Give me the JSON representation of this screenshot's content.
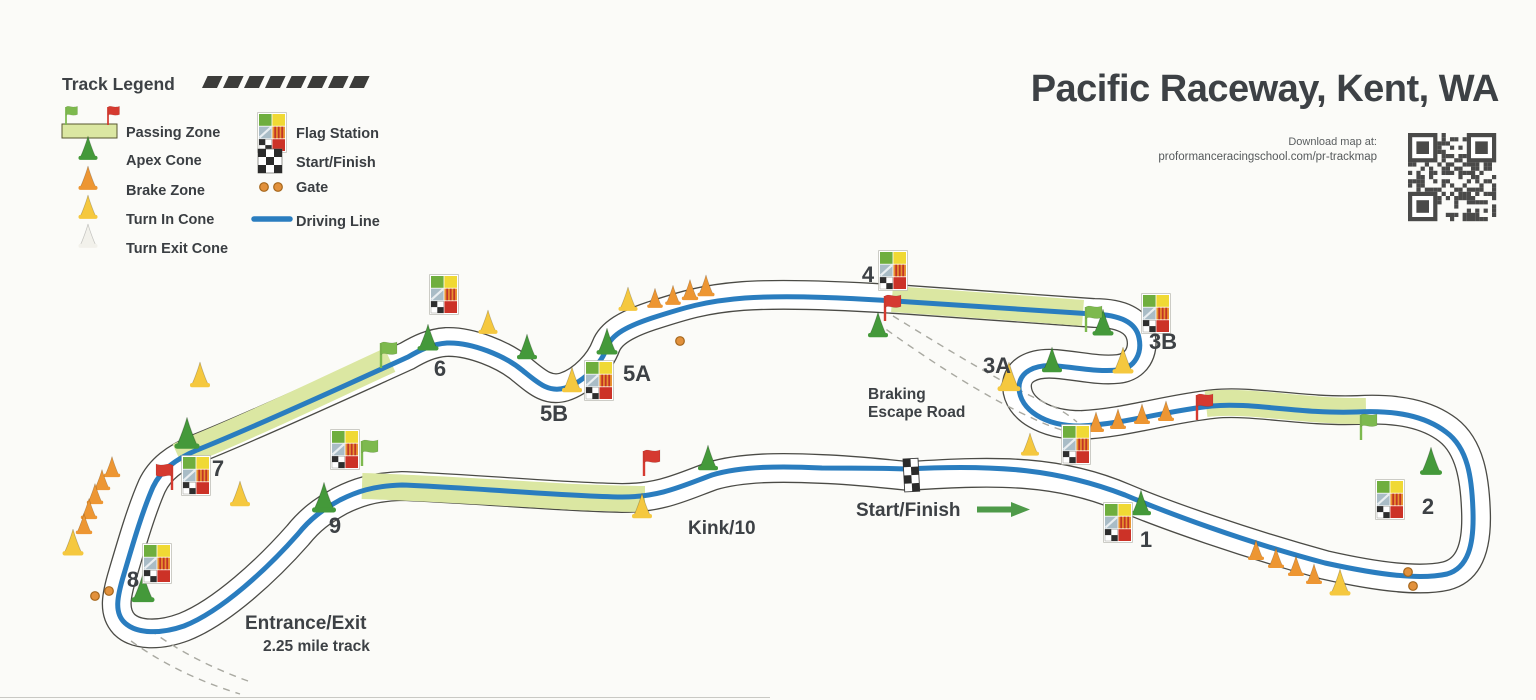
{
  "header": {
    "title": "Pacific Raceway, Kent, WA",
    "download_note": "Download map at:",
    "download_url": "proformanceracingschool.com/pr-trackmap"
  },
  "legend": {
    "title": "Track Legend",
    "left_items": [
      "Passing Zone",
      "Apex Cone",
      "Brake Zone",
      "Turn In Cone",
      "Turn Exit Cone"
    ],
    "right_items": [
      "Flag Station",
      "Start/Finish",
      "Gate",
      "Driving Line"
    ]
  },
  "labels": {
    "start_finish": "Start/Finish",
    "kink": "Kink/10",
    "braking_line1": "Braking",
    "braking_line2": "Escape Road",
    "entrance": "Entrance/Exit",
    "track_length": "2.25 mile track"
  },
  "turns": [
    {
      "id": "1",
      "x": 1146,
      "y": 547
    },
    {
      "id": "2",
      "x": 1428,
      "y": 514
    },
    {
      "id": "3A",
      "x": 997,
      "y": 373
    },
    {
      "id": "3B",
      "x": 1163,
      "y": 349
    },
    {
      "id": "4",
      "x": 868,
      "y": 282
    },
    {
      "id": "5A",
      "x": 637,
      "y": 381
    },
    {
      "id": "5B",
      "x": 554,
      "y": 421
    },
    {
      "id": "6",
      "x": 440,
      "y": 376
    },
    {
      "id": "7",
      "x": 218,
      "y": 476
    },
    {
      "id": "8",
      "x": 133,
      "y": 587
    },
    {
      "id": "9",
      "x": 335,
      "y": 533
    }
  ],
  "markers": {
    "cones": [
      {
        "t": "apex",
        "x": 187,
        "y": 441,
        "s": 1.25
      },
      {
        "t": "apex",
        "x": 143,
        "y": 595,
        "s": 1.15
      },
      {
        "t": "apex",
        "x": 324,
        "y": 505,
        "s": 1.2
      },
      {
        "t": "apex",
        "x": 708,
        "y": 464,
        "s": 1.0
      },
      {
        "t": "apex",
        "x": 1141,
        "y": 509,
        "s": 1.0
      },
      {
        "t": "apex",
        "x": 1431,
        "y": 468,
        "s": 1.1
      },
      {
        "t": "apex",
        "x": 1052,
        "y": 366,
        "s": 1.0
      },
      {
        "t": "apex",
        "x": 1103,
        "y": 329,
        "s": 1.05
      },
      {
        "t": "apex",
        "x": 878,
        "y": 331,
        "s": 1.0
      },
      {
        "t": "apex",
        "x": 607,
        "y": 348,
        "s": 1.05
      },
      {
        "t": "apex",
        "x": 527,
        "y": 353,
        "s": 1.0
      },
      {
        "t": "apex",
        "x": 428,
        "y": 344,
        "s": 1.05
      },
      {
        "t": "brake",
        "x": 112,
        "y": 472,
        "s": 0.82
      },
      {
        "t": "brake",
        "x": 102,
        "y": 485,
        "s": 0.82
      },
      {
        "t": "brake",
        "x": 95,
        "y": 499,
        "s": 0.82
      },
      {
        "t": "brake",
        "x": 89,
        "y": 514,
        "s": 0.82
      },
      {
        "t": "brake",
        "x": 84,
        "y": 529,
        "s": 0.82
      },
      {
        "t": "brake",
        "x": 655,
        "y": 303,
        "s": 0.78
      },
      {
        "t": "brake",
        "x": 673,
        "y": 300,
        "s": 0.78
      },
      {
        "t": "brake",
        "x": 690,
        "y": 295,
        "s": 0.82
      },
      {
        "t": "brake",
        "x": 706,
        "y": 291,
        "s": 0.85
      },
      {
        "t": "brake",
        "x": 1096,
        "y": 427,
        "s": 0.8
      },
      {
        "t": "brake",
        "x": 1118,
        "y": 424,
        "s": 0.8
      },
      {
        "t": "brake",
        "x": 1142,
        "y": 419,
        "s": 0.8
      },
      {
        "t": "brake",
        "x": 1166,
        "y": 416,
        "s": 0.8
      },
      {
        "t": "brake",
        "x": 1256,
        "y": 555,
        "s": 0.8
      },
      {
        "t": "brake",
        "x": 1276,
        "y": 563,
        "s": 0.8
      },
      {
        "t": "brake",
        "x": 1296,
        "y": 571,
        "s": 0.8
      },
      {
        "t": "brake",
        "x": 1314,
        "y": 579,
        "s": 0.8
      },
      {
        "t": "turnin",
        "x": 73,
        "y": 549,
        "s": 1.05
      },
      {
        "t": "turnin",
        "x": 200,
        "y": 381,
        "s": 1.0
      },
      {
        "t": "turnin",
        "x": 240,
        "y": 500,
        "s": 1.0
      },
      {
        "t": "turnin",
        "x": 488,
        "y": 328,
        "s": 0.95
      },
      {
        "t": "turnin",
        "x": 572,
        "y": 386,
        "s": 1.0
      },
      {
        "t": "turnin",
        "x": 628,
        "y": 305,
        "s": 0.95
      },
      {
        "t": "turnin",
        "x": 642,
        "y": 512,
        "s": 1.0
      },
      {
        "t": "turnin",
        "x": 1009,
        "y": 384,
        "s": 1.15
      },
      {
        "t": "turnin",
        "x": 1030,
        "y": 450,
        "s": 0.9
      },
      {
        "t": "turnin",
        "x": 1123,
        "y": 367,
        "s": 1.05
      },
      {
        "t": "turnin",
        "x": 1340,
        "y": 589,
        "s": 1.05
      }
    ],
    "flags": [
      {
        "c": "green",
        "x": 362,
        "y": 466
      },
      {
        "c": "green",
        "x": 381,
        "y": 368
      },
      {
        "c": "green",
        "x": 1086,
        "y": 332
      },
      {
        "c": "green",
        "x": 1361,
        "y": 440
      },
      {
        "c": "red",
        "x": 172,
        "y": 490,
        "flip": true
      },
      {
        "c": "red",
        "x": 644,
        "y": 476
      },
      {
        "c": "red",
        "x": 885,
        "y": 321
      },
      {
        "c": "red",
        "x": 1197,
        "y": 420
      }
    ],
    "stations": [
      {
        "x": 880,
        "y": 252
      },
      {
        "x": 1143,
        "y": 295
      },
      {
        "x": 1063,
        "y": 426
      },
      {
        "x": 1377,
        "y": 481
      },
      {
        "x": 1105,
        "y": 504
      },
      {
        "x": 586,
        "y": 362
      },
      {
        "x": 431,
        "y": 276
      },
      {
        "x": 183,
        "y": 457
      },
      {
        "x": 144,
        "y": 545
      },
      {
        "x": 332,
        "y": 431
      }
    ],
    "gates": [
      {
        "x": 95,
        "y": 596
      },
      {
        "x": 109,
        "y": 591
      },
      {
        "x": 680,
        "y": 341
      },
      {
        "x": 1408,
        "y": 572
      },
      {
        "x": 1413,
        "y": 586
      }
    ],
    "start_finish_band": {
      "x": 903,
      "y": 459,
      "rotate": -3
    }
  },
  "colors": {
    "boundary": "#4b4b46",
    "road": "#ffffff",
    "passing_zone": "#dbe7a2",
    "driving_line": "#2a7dbf",
    "apex_cone": "#44993a",
    "brake_cone": "#ed9633",
    "turn_in_cone": "#f5c83f",
    "turn_exit_cone": "#f2f1ea",
    "flag_red": "#d53a30",
    "flag_green": "#7db94e",
    "gate": "#e2913c",
    "text": "#3d4145",
    "dashed_road": "#a9a9a1"
  }
}
